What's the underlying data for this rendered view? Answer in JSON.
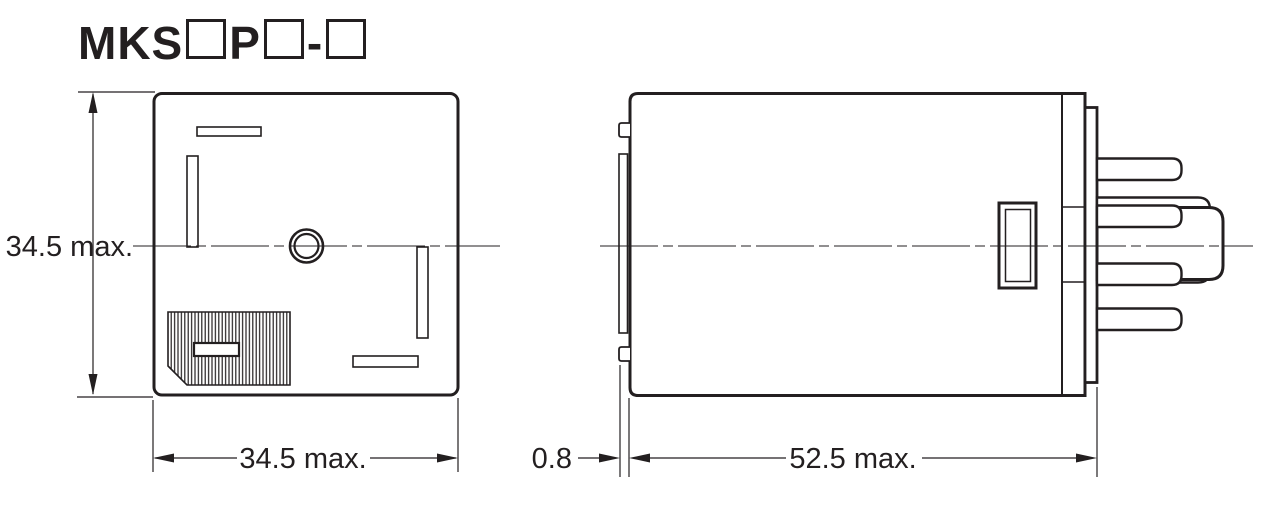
{
  "page": {
    "background_color": "#ffffff",
    "ink_color": "#231f20",
    "description_type": "relay-dimension-drawing"
  },
  "title": {
    "model_prefix": "MKS",
    "model_letter": "P",
    "separator": "-",
    "placeholder_box_count": 3
  },
  "front_view": {
    "height_label": "34.5 max.",
    "width_label": "34.5 max."
  },
  "side_view": {
    "flange_label": "0.8",
    "depth_label": "52.5 max."
  }
}
